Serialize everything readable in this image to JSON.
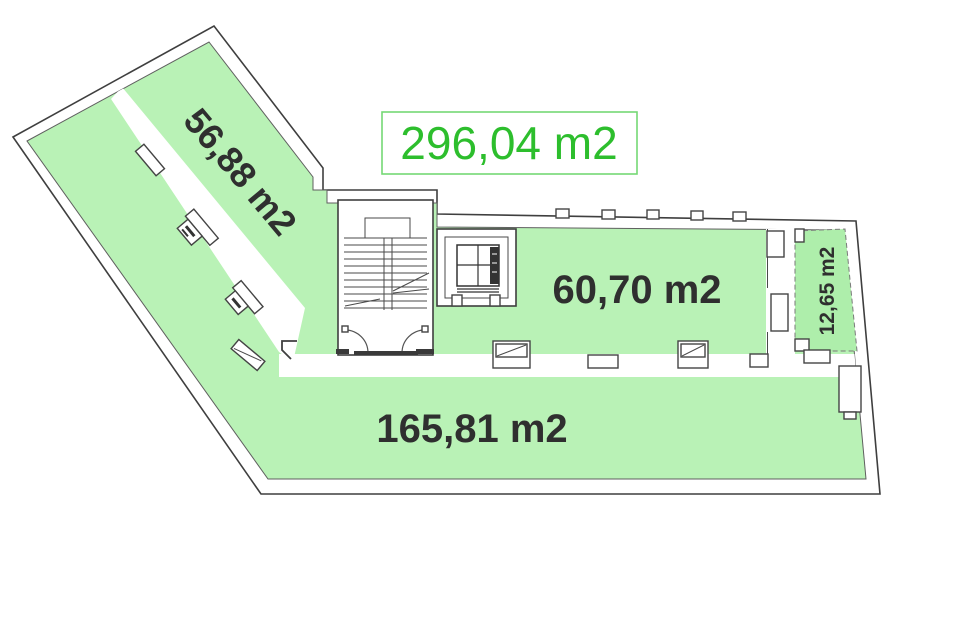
{
  "title_box": {
    "total_area_label": "296,04 m2"
  },
  "rooms": {
    "wing": {
      "label": "56,88 m2"
    },
    "middle": {
      "label": "60,70 m2"
    },
    "side": {
      "label": "12,65 m2"
    },
    "main": {
      "label": "165,81 m2"
    }
  },
  "colors": {
    "room_fill": "#b9f2b6",
    "side_room_fill": "#aeeeab",
    "accent_green": "#2dbe2d",
    "box_border": "#74d874",
    "wall_line": "#3f3f3f",
    "label_text": "#2f2f2f"
  }
}
